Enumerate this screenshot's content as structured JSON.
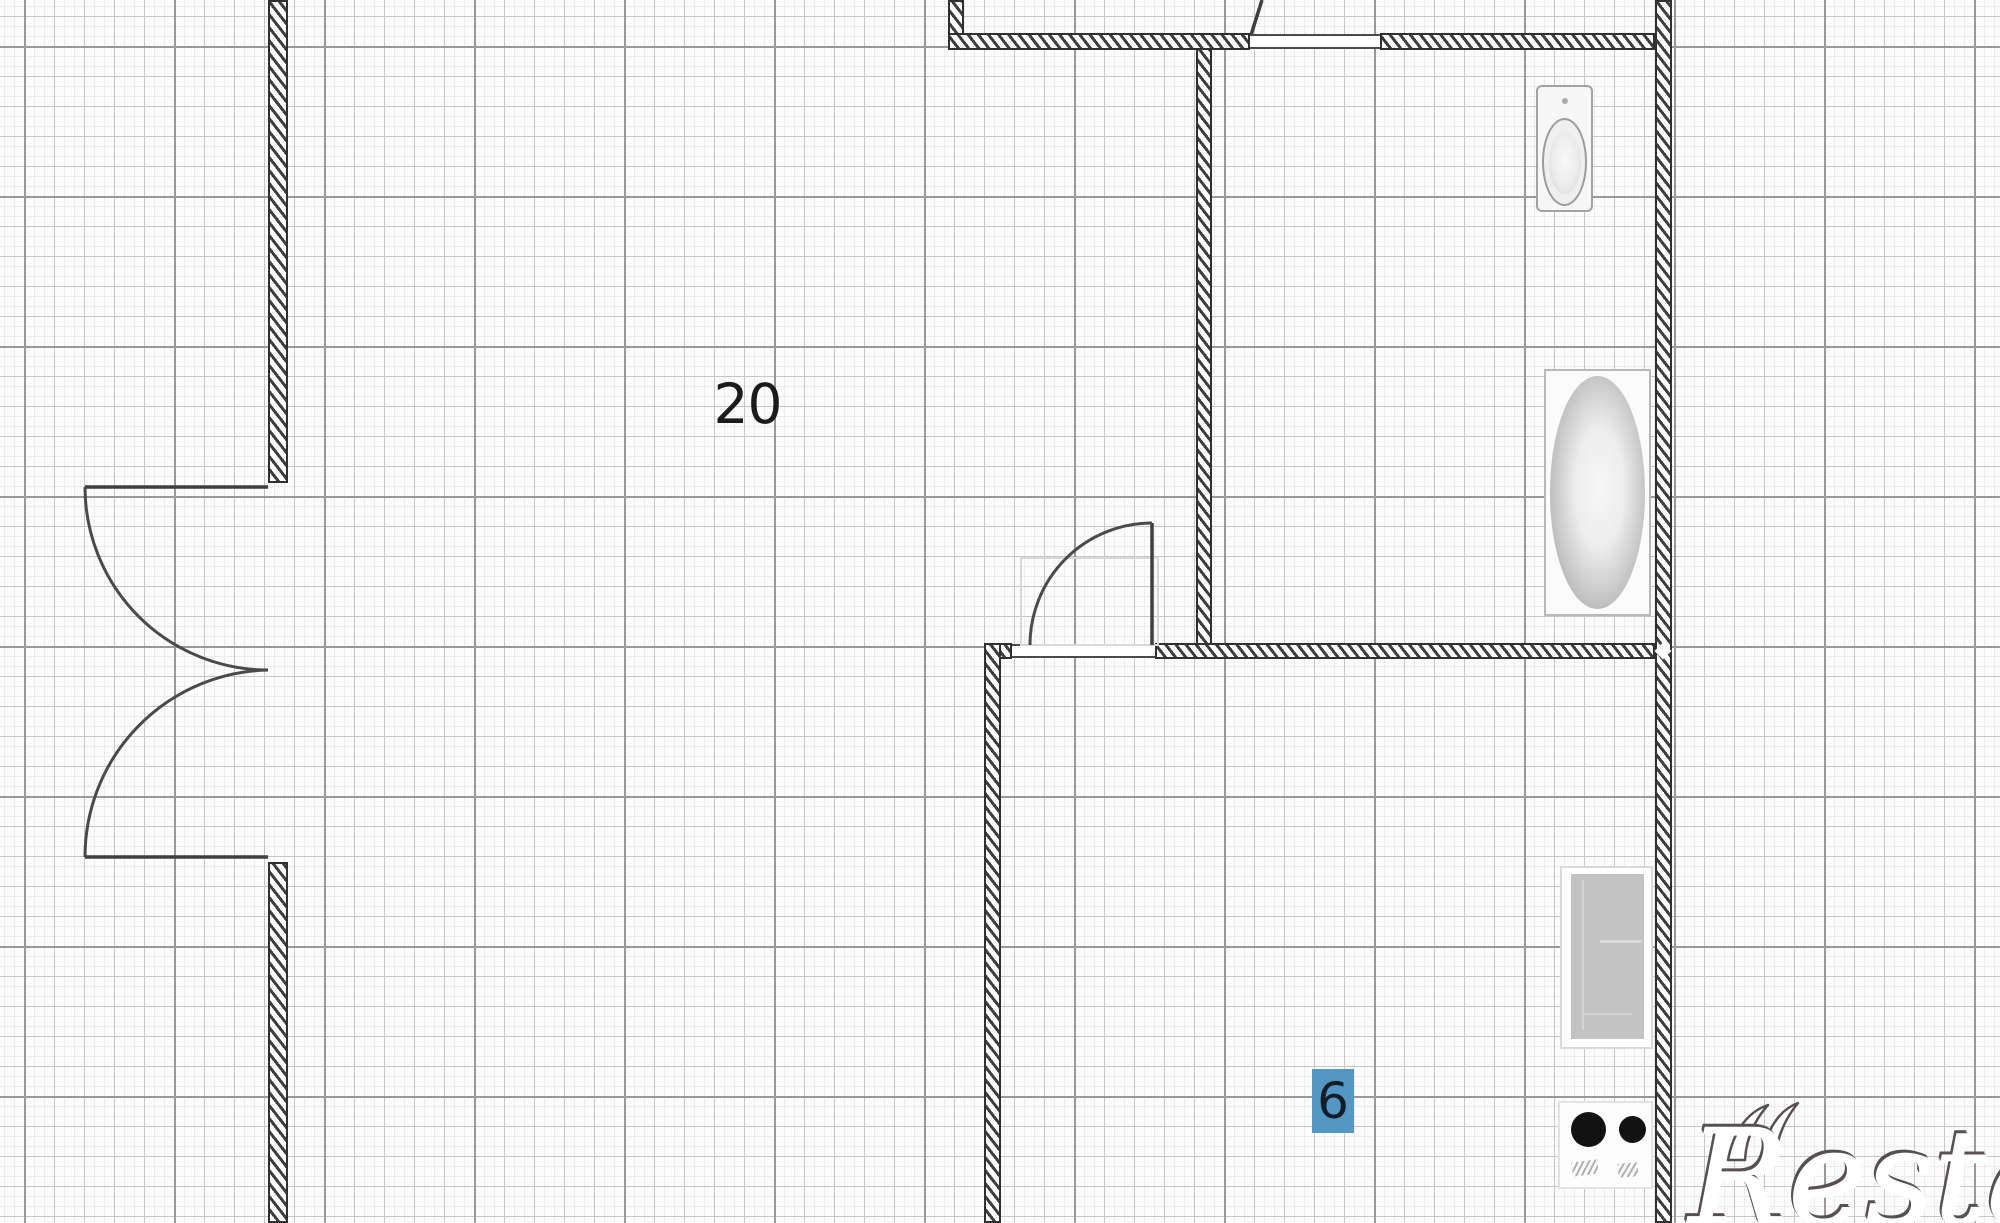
{
  "floorplan": {
    "type": "apartment-floor-plan",
    "rooms": [
      {
        "id": "room-20",
        "label": "20"
      },
      {
        "id": "room-6",
        "label": "6"
      }
    ],
    "fixtures": [
      "toilet",
      "bathtub",
      "counter",
      "stove"
    ],
    "watermark": {
      "text": "Restate"
    },
    "colors": {
      "paper": "#fcfcfc",
      "grid_fine": "#ececec",
      "grid_medium": "#c6c6c6",
      "grid_major": "#999999",
      "wall_dark": "#303030",
      "wall_hatch": "#3d3d3d",
      "door_line": "#3f3f3f",
      "fixture_gray": "#c3c3c3",
      "label_dark": "#1b1b1b",
      "room6_highlight": "#5596c4",
      "room6_digit": "#111e2a",
      "watermark_edge": "#575050"
    }
  }
}
